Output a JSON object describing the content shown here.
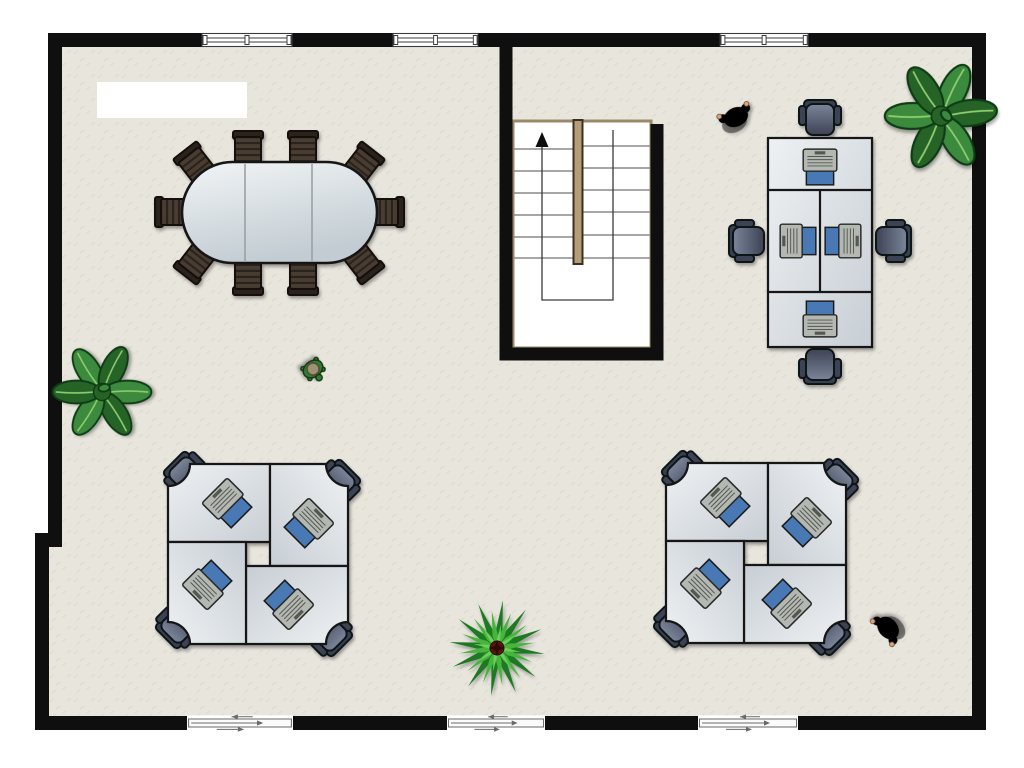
{
  "meta": {
    "title": "Office floor plan (top-down view)",
    "canvas": {
      "width": 1024,
      "height": 768
    }
  },
  "palette": {
    "wall": "#0f0f0f",
    "floor_base": "#e7e5dc",
    "floor_speckle": "#d6d3c6",
    "desk_light": "#eef1f3",
    "desk_dark": "#c7ced4",
    "desk_border": "#141414",
    "table_light": "#f1f4f6",
    "table_dark": "#c2ccd2",
    "seat_light": "#7b8499",
    "seat_dark": "#3d4354",
    "chair_back": "#39404f",
    "chair_outline": "#0f1219",
    "conf_slat_a": "#4a3e33",
    "conf_slat_b": "#2c241c",
    "conf_outline": "#140e08",
    "laptop_body": "#b4b8b2",
    "laptop_keys": "#55584f",
    "laptop_screen": "#4a79b5",
    "stair_trim": "#9a8a67",
    "stair_divider": "#b49e78",
    "stair_divider_edge": "#3c2f1f",
    "tread_line": "#8a8a8a",
    "walk_line": "#3a3a3a",
    "window_frame": "#3c3c3c",
    "door_panel": "#6a6a6a",
    "plant_dark": "#256428",
    "plant_mid": "#3b8a3c",
    "plant_vein": "#8fce6f",
    "plant_outline": "#103b12",
    "palm_light": "#46b53b",
    "palm_dark": "#1f7a24",
    "palm_center": "#5a150e",
    "person_red": "#b71719",
    "person_red_dark": "#7e0e10",
    "person_purple": "#7a72d4",
    "person_purple_dark": "#4a44a0",
    "hair_brown": "#77491f",
    "hair_black": "#161616",
    "skin": "#d9a57e",
    "turtle_body": "#2f7c34",
    "turtle_shell": "#9e9176"
  },
  "objects": {
    "label": {
      "text": ""
    },
    "conference_table": {
      "seats": 10,
      "sections": 3,
      "shape": "oval"
    },
    "staircase": {
      "flights": 2,
      "treads_per_flight": 7,
      "direction": "up",
      "symbol": "up-arrow"
    },
    "desk_clusters": [
      {
        "id": "bench-top-right",
        "layout": "inline bench",
        "desks": 4,
        "chairs": 4,
        "laptops": 4
      },
      {
        "id": "quad-bottom-left",
        "layout": "pinwheel",
        "desks": 4,
        "chairs": 4,
        "laptops": 4
      },
      {
        "id": "quad-bottom-right",
        "layout": "pinwheel",
        "desks": 4,
        "chairs": 4,
        "laptops": 4
      }
    ],
    "plants": [
      {
        "id": "plant-top-right",
        "type": "broadleaf"
      },
      {
        "id": "plant-left-wall",
        "type": "broadleaf"
      },
      {
        "id": "plant-bottom-center",
        "type": "palm"
      }
    ],
    "people": [
      {
        "id": "person-red",
        "shirt": "red",
        "hair": "brown"
      },
      {
        "id": "person-purple",
        "shirt": "purple",
        "hair": "black"
      }
    ],
    "pet": {
      "id": "turtle"
    },
    "windows": {
      "count": 3,
      "wall": "top"
    },
    "doors": {
      "count": 3,
      "wall": "bottom",
      "type": "sliding"
    }
  }
}
